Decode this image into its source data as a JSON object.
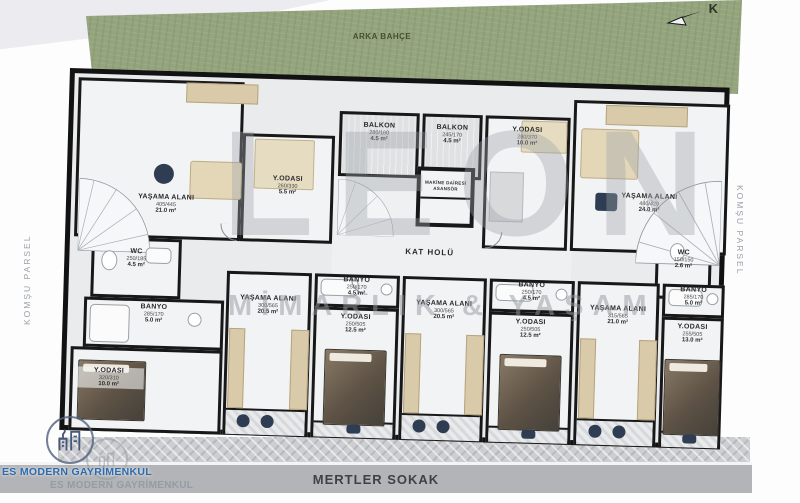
{
  "site": {
    "back_garden": "ARKA BAHÇE",
    "left_parcel": "KOMŞU PARSEL",
    "right_parcel": "KOMŞU PARSEL",
    "street": "MERTLER SOKAK",
    "compass_north": "K"
  },
  "watermark": {
    "brand": "LEON",
    "registered": "®",
    "tagline": "MİMARLIK & YAŞAM",
    "agency": "ES MODERN GAYRİMENKUL",
    "agency_shadow": "ES MODERN GAYRİMENKUL"
  },
  "rooms": {
    "unit_tl_living": {
      "label": "YAŞAMA ALANI",
      "dims": "405/445",
      "area": "21.0 m²"
    },
    "unit_tl_bedroom": {
      "label": "Y.ODASI",
      "dims": "260/330",
      "area": "5.5 m²"
    },
    "balcony_1": {
      "label": "BALKON",
      "dims": "280/160",
      "area": "4.5 m²"
    },
    "balcony_2": {
      "label": "BALKON",
      "dims": "245/170",
      "area": "4.5 m²"
    },
    "bedroom_top": {
      "label": "Y.ODASI",
      "dims": "280/370",
      "area": "10.0 m²"
    },
    "unit_tr_living": {
      "label": "YAŞAMA ALANI",
      "dims": "440/420",
      "area": "24.0 m²"
    },
    "wc_right": {
      "label": "WC",
      "dims": "150/150",
      "area": "2.6 m²"
    },
    "wc_left": {
      "label": "WC",
      "dims": "250/185",
      "area": "4.5 m²"
    },
    "hall": {
      "label": "KAT HOLÜ"
    },
    "elevator": {
      "label": "MAKİNE DAİRESİ",
      "label2": "ASANSÖR"
    },
    "bath_left": {
      "label": "BANYO",
      "dims": "285/170",
      "area": "5.0 m²"
    },
    "bedroom_left": {
      "label": "Y.ODASI",
      "dims": "320/310",
      "area": "10.0 m²"
    },
    "living_2": {
      "label": "YAŞAMA ALANI",
      "dims": "300/565",
      "area": "20.5 m²"
    },
    "bath_3": {
      "label": "BANYO",
      "dims": "250/170",
      "area": "4.5 m²"
    },
    "bedroom_3": {
      "label": "Y.ODASI",
      "dims": "250/505",
      "area": "12.5 m²"
    },
    "living_4": {
      "label": "YAŞAMA ALANI",
      "dims": "300/565",
      "area": "20.5 m²"
    },
    "bath_5": {
      "label": "BANYO",
      "dims": "250/170",
      "area": "4.5 m²"
    },
    "bedroom_5": {
      "label": "Y.ODASI",
      "dims": "250/505",
      "area": "12.5 m²"
    },
    "living_6": {
      "label": "YAŞAMA ALANI",
      "dims": "315/565",
      "area": "21.0 m²"
    },
    "bath_7": {
      "label": "BANYO",
      "dims": "285/170",
      "area": "5.0 m²"
    },
    "bedroom_7": {
      "label": "Y.ODASI",
      "dims": "255/505",
      "area": "13.0 m²"
    }
  },
  "colors": {
    "garden_green": "#94a57e",
    "wall_black": "#121212",
    "accent_navy": "#2e3d52",
    "furniture_beige": "#d9cba9",
    "street_gray": "#b2b4b7",
    "logo_blue": "#2d6bb0"
  }
}
